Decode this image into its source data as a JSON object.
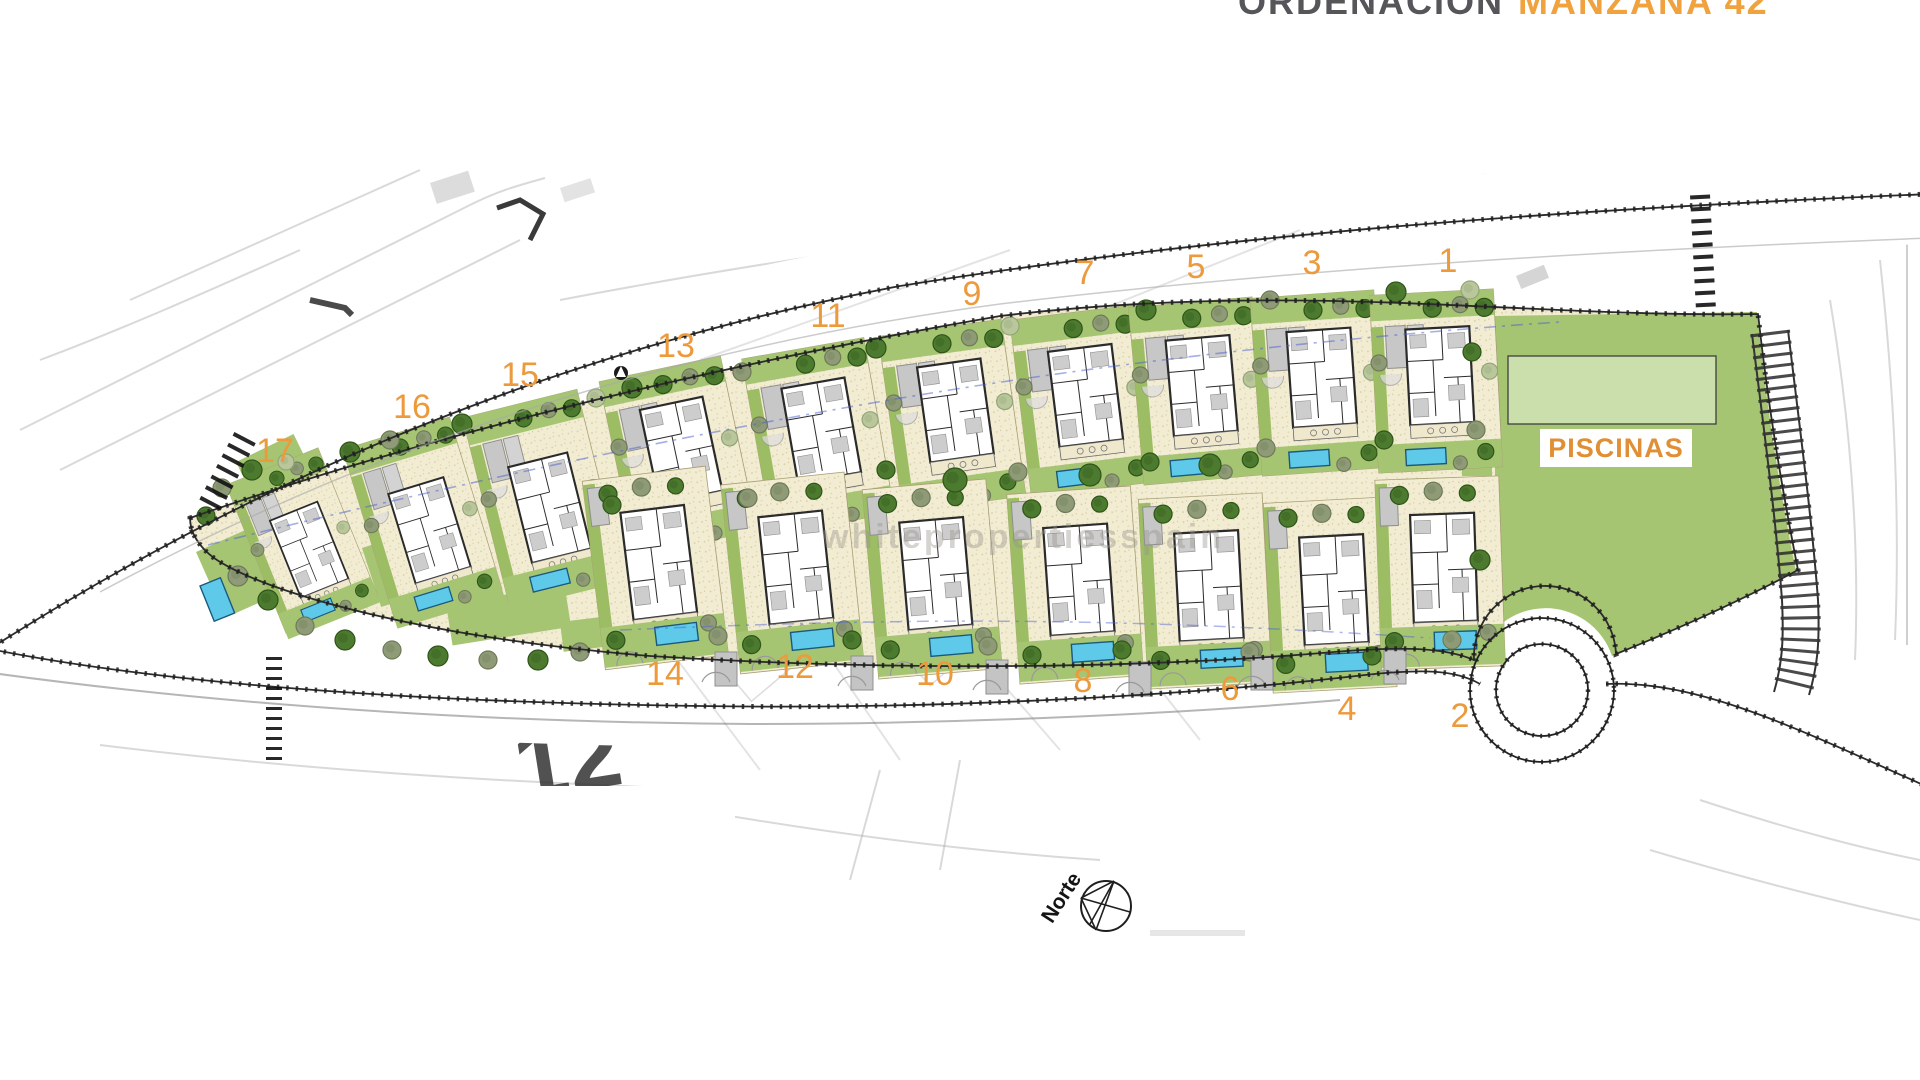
{
  "title": {
    "prefix": "ORDENACIÓN",
    "highlight": "MANZANA 42"
  },
  "labels": {
    "piscinas": "PISCINAS",
    "north": "Norte",
    "watermark": "whitepropertiesspain",
    "sketch_parcel_number": "12"
  },
  "colors": {
    "accent_orange": "#EC9A3C",
    "title_gray": "#55565A",
    "title_orange": "#F0A23E",
    "garden_green": "#A6C573",
    "hedge_green": "#9CBD63",
    "pool_zone_green": "#CBDFAC",
    "pool_blue": "#5FC9E9",
    "parcel_beige": "#F2ECD2",
    "road_ink": "#1F1F1F",
    "tree_dark": "#4C7A2E",
    "tree_olive": "#8E9B76",
    "tree_sage": "#B9C79B"
  },
  "plots": {
    "upper": [
      {
        "num": "17",
        "label": {
          "x": 275,
          "y": 462
        },
        "house": {
          "x": 305,
          "y": 548,
          "rot": -22,
          "scale": 0.8
        },
        "garden": "full"
      },
      {
        "num": "16",
        "label": {
          "x": 412,
          "y": 418
        },
        "house": {
          "x": 425,
          "y": 528,
          "rot": -17,
          "scale": 0.9
        },
        "garden": "full"
      },
      {
        "num": "15",
        "label": {
          "x": 520,
          "y": 386
        },
        "house": {
          "x": 545,
          "y": 505,
          "rot": -14,
          "scale": 0.95
        },
        "garden": "full"
      },
      {
        "num": "13",
        "label": {
          "x": 676,
          "y": 357
        },
        "house": {
          "x": 678,
          "y": 455,
          "rot": -12,
          "scale": 1
        },
        "garden": "short"
      },
      {
        "num": "11",
        "label": {
          "x": 828,
          "y": 327
        },
        "house": {
          "x": 818,
          "y": 435,
          "rot": -10,
          "scale": 1
        },
        "garden": "short"
      },
      {
        "num": "9",
        "label": {
          "x": 972,
          "y": 305
        },
        "house": {
          "x": 952,
          "y": 415,
          "rot": -8,
          "scale": 1
        },
        "garden": "short"
      },
      {
        "num": "7",
        "label": {
          "x": 1085,
          "y": 284
        },
        "house": {
          "x": 1082,
          "y": 400,
          "rot": -7,
          "scale": 1
        },
        "garden": "short"
      },
      {
        "num": "5",
        "label": {
          "x": 1196,
          "y": 278
        },
        "house": {
          "x": 1198,
          "y": 390,
          "rot": -5,
          "scale": 1
        },
        "garden": "short"
      },
      {
        "num": "3",
        "label": {
          "x": 1312,
          "y": 274
        },
        "house": {
          "x": 1318,
          "y": 382,
          "rot": -4,
          "scale": 1
        },
        "garden": "short"
      },
      {
        "num": "1",
        "label": {
          "x": 1448,
          "y": 272
        },
        "house": {
          "x": 1436,
          "y": 380,
          "rot": -3,
          "scale": 1
        },
        "garden": "short"
      }
    ],
    "lower": [
      {
        "num": "14",
        "label": {
          "x": 665,
          "y": 685
        },
        "house": {
          "x": 655,
          "y": 565,
          "rot": -7,
          "scale": 1
        }
      },
      {
        "num": "12",
        "label": {
          "x": 795,
          "y": 678
        },
        "house": {
          "x": 792,
          "y": 570,
          "rot": -6,
          "scale": 1
        }
      },
      {
        "num": "10",
        "label": {
          "x": 935,
          "y": 685
        },
        "house": {
          "x": 932,
          "y": 576,
          "rot": -5,
          "scale": 1
        }
      },
      {
        "num": "8",
        "label": {
          "x": 1083,
          "y": 692
        },
        "house": {
          "x": 1075,
          "y": 582,
          "rot": -4,
          "scale": 1
        }
      },
      {
        "num": "6",
        "label": {
          "x": 1230,
          "y": 700
        },
        "house": {
          "x": 1205,
          "y": 588,
          "rot": -3,
          "scale": 1
        }
      },
      {
        "num": "4",
        "label": {
          "x": 1347,
          "y": 720
        },
        "house": {
          "x": 1330,
          "y": 592,
          "rot": -3,
          "scale": 1
        }
      },
      {
        "num": "2",
        "label": {
          "x": 1460,
          "y": 727
        },
        "house": {
          "x": 1440,
          "y": 570,
          "rot": -2,
          "scale": 1
        }
      }
    ]
  },
  "trees": [
    [
      350,
      452,
      10,
      "d"
    ],
    [
      390,
      440,
      9,
      "o"
    ],
    [
      462,
      424,
      10,
      "d"
    ],
    [
      596,
      398,
      9,
      "s"
    ],
    [
      632,
      388,
      10,
      "d"
    ],
    [
      742,
      372,
      9,
      "o"
    ],
    [
      876,
      348,
      10,
      "d"
    ],
    [
      1010,
      326,
      9,
      "s"
    ],
    [
      1146,
      310,
      10,
      "d"
    ],
    [
      1270,
      300,
      9,
      "o"
    ],
    [
      1396,
      292,
      10,
      "d"
    ],
    [
      1470,
      290,
      9,
      "s"
    ],
    [
      222,
      488,
      9,
      "o"
    ],
    [
      252,
      470,
      10,
      "d"
    ],
    [
      286,
      462,
      8,
      "s"
    ],
    [
      206,
      516,
      9,
      "d"
    ],
    [
      238,
      576,
      10,
      "o"
    ],
    [
      268,
      600,
      10,
      "d"
    ],
    [
      305,
      626,
      9,
      "o"
    ],
    [
      345,
      640,
      10,
      "d"
    ],
    [
      392,
      650,
      9,
      "o"
    ],
    [
      438,
      656,
      10,
      "d"
    ],
    [
      488,
      660,
      9,
      "o"
    ],
    [
      538,
      660,
      10,
      "d"
    ],
    [
      580,
      652,
      9,
      "o"
    ],
    [
      612,
      505,
      9,
      "d"
    ],
    [
      748,
      498,
      9,
      "o"
    ],
    [
      886,
      470,
      9,
      "d"
    ],
    [
      1018,
      472,
      9,
      "o"
    ],
    [
      1150,
      462,
      9,
      "d"
    ],
    [
      1266,
      448,
      9,
      "o"
    ],
    [
      1384,
      440,
      9,
      "d"
    ],
    [
      955,
      480,
      12,
      "d"
    ],
    [
      1090,
      475,
      11,
      "d"
    ],
    [
      1210,
      465,
      11,
      "d"
    ],
    [
      718,
      636,
      9,
      "o"
    ],
    [
      852,
      640,
      9,
      "d"
    ],
    [
      988,
      646,
      9,
      "o"
    ],
    [
      1122,
      650,
      9,
      "d"
    ],
    [
      1250,
      652,
      9,
      "o"
    ],
    [
      1372,
      656,
      9,
      "d"
    ],
    [
      1452,
      640,
      9,
      "o"
    ],
    [
      1472,
      352,
      9,
      "d"
    ],
    [
      1476,
      430,
      9,
      "o"
    ],
    [
      1480,
      560,
      10,
      "d"
    ]
  ],
  "greens": [
    [
      236,
      462,
      64,
      40,
      -26
    ],
    [
      196,
      552,
      56,
      72,
      -24
    ],
    [
      362,
      548,
      92,
      62,
      -18
    ],
    [
      446,
      604,
      120,
      42,
      -9
    ],
    [
      560,
      622,
      64,
      30,
      -7
    ],
    [
      1462,
      326,
      30,
      150,
      0
    ],
    [
      1452,
      600,
      48,
      40,
      -4
    ]
  ],
  "pools_standalone": [
    [
      200,
      586,
      22,
      38,
      -22
    ]
  ],
  "driveway_stubs": [
    [
      726,
      668
    ],
    [
      862,
      672
    ],
    [
      997,
      676
    ],
    [
      1140,
      678
    ],
    [
      1262,
      672
    ],
    [
      1395,
      666
    ]
  ]
}
